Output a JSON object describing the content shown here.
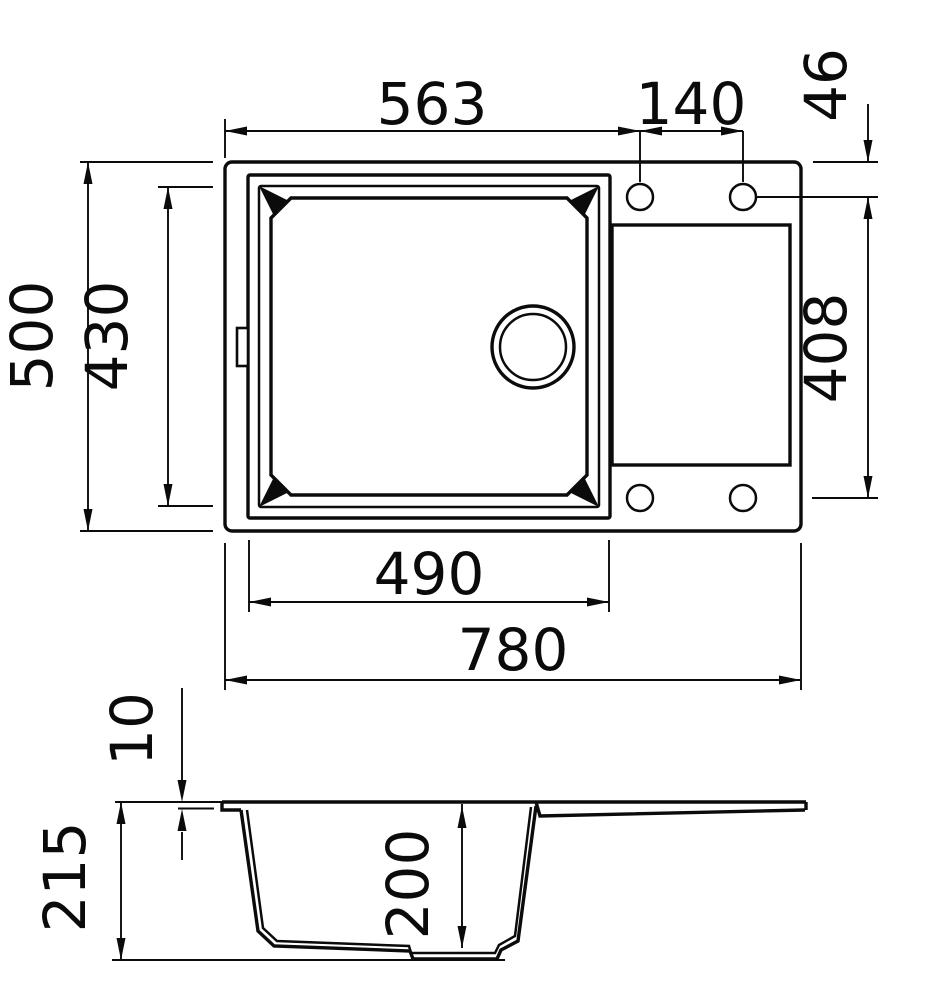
{
  "drawing": {
    "title": "Kitchen sink dimensional drawing",
    "top_view": {
      "dims": {
        "edge_to_first_hole": "563",
        "hole_spacing": "140",
        "hole_to_top_edge": "46",
        "overall_depth": "500",
        "bowl_opening_depth": "430",
        "hole_rows_spacing": "408",
        "bowl_opening_width": "490",
        "overall_width": "780"
      }
    },
    "side_view": {
      "dims": {
        "rim_lip_height": "10",
        "overall_height": "215",
        "bowl_depth": "200"
      }
    }
  }
}
